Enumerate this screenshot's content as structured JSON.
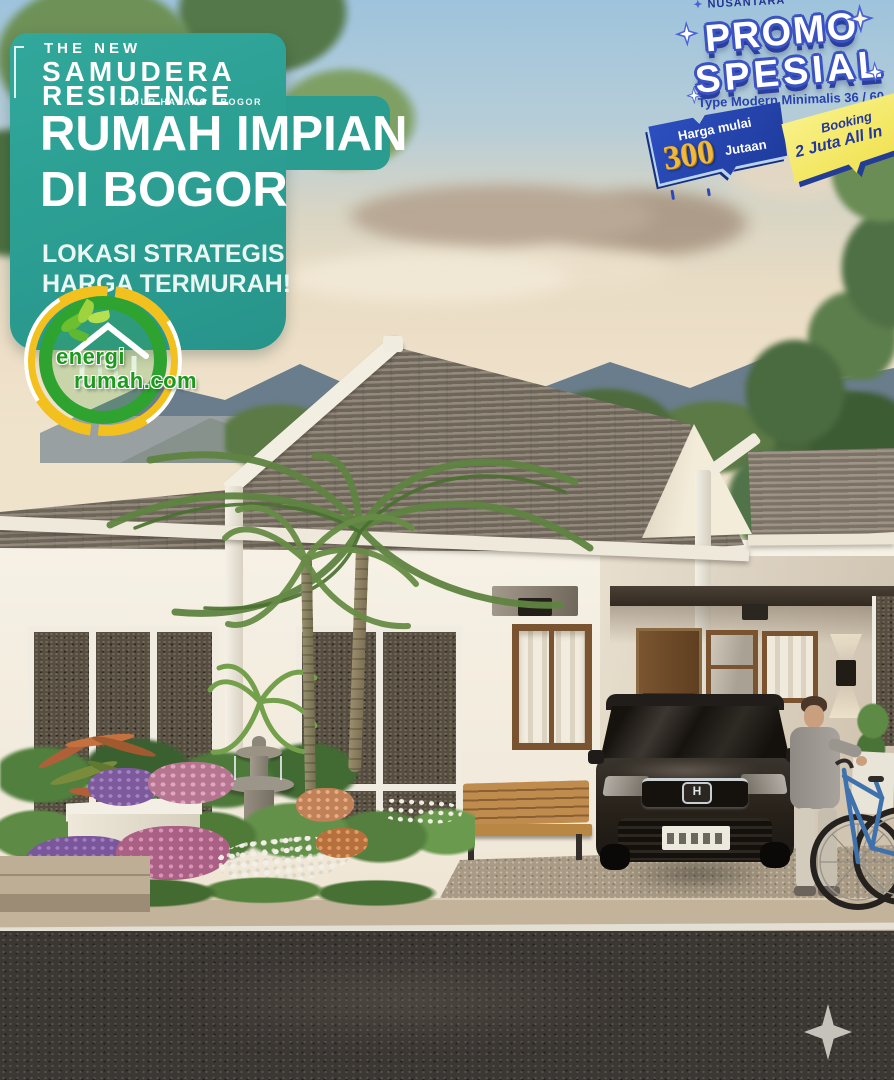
{
  "banner": {
    "kicker": "THE NEW",
    "brand_line1": "SAMUDERA",
    "brand_line2": "RESIDENCE",
    "location": "TAJUR HALANG - BOGOR",
    "headline_line1": "RUMAH IMPIAN",
    "headline_line2": "DI BOGOR",
    "tagline_line1": "LOKASI STRATEGIS",
    "tagline_line2": "HARGA TERMURAH!"
  },
  "promo": {
    "brand_partial": "NUSANTARA",
    "title_line1": "PROMO",
    "title_line2": "SPESIAL",
    "subtitle": "Type Modern Minimalis 36 / 60"
  },
  "price_ribbon": {
    "line1": "Harga mulai",
    "amount": "300",
    "unit": "Jutaan"
  },
  "booking_ribbon": {
    "line1": "Booking",
    "line2": "2 Juta All In"
  },
  "logo": {
    "line1": "energi",
    "line2": "rumah.com"
  },
  "car": {
    "emblem": "H"
  },
  "icons": {
    "sparkle_icon": "four-point-star",
    "promo_star_icon": "four-point-sparkle",
    "logo_leaf_icon": "leaf-cluster",
    "logo_house_icon": "eco-house-outline"
  },
  "colors": {
    "banner_teal": "#2b9c90",
    "promo_blue": "#3a52c2",
    "promo_shadow_blue": "#2a3e9c",
    "ribbon_navy": "#2a4ab8",
    "ribbon_gold": "#f0b93c",
    "ribbon_yellow": "#f5e75f",
    "logo_green": "#2fa32f",
    "logo_yellow": "#f3c11d",
    "sky_blue": "#9ec3dc",
    "roof_gray": "#877d6e",
    "wall_cream": "#f6f1e6",
    "road_dark": "#3b3733",
    "sparkle_gray": "#ccc9c2"
  }
}
